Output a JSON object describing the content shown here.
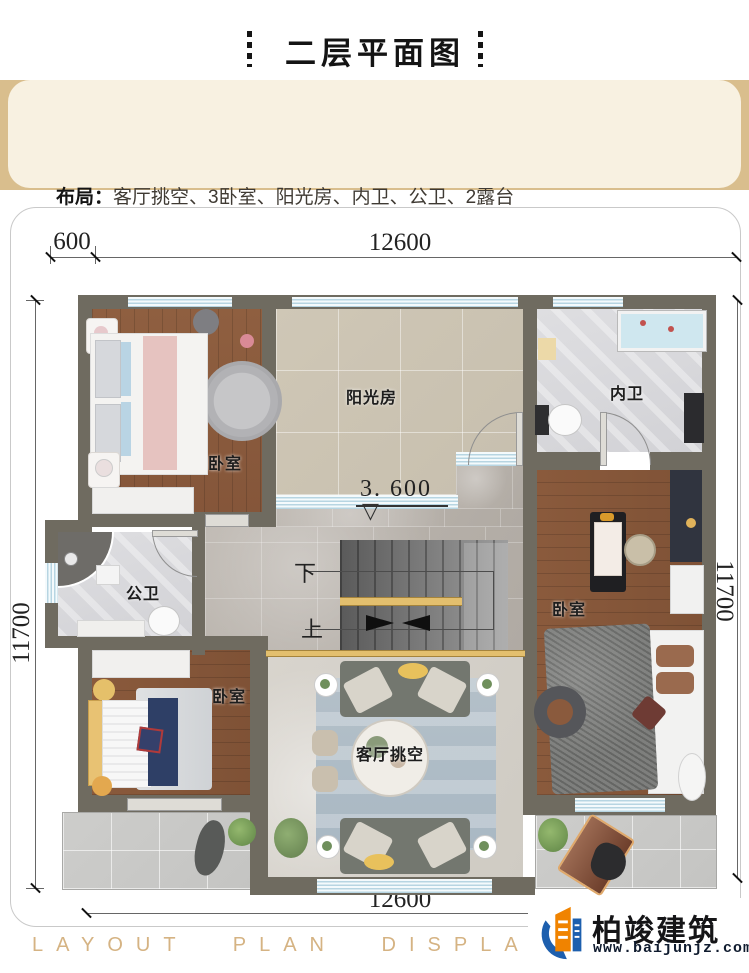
{
  "header": {
    "title": "二层平面图"
  },
  "info": {
    "layout_label": "布局：",
    "layout_value": "客厅挑空、3卧室、阳光房、内卫、公卫、2露台",
    "diamond": "◆",
    "area_label": "本层建筑面积:",
    "area_value": "125.24m",
    "area_sup": "2",
    "accent_color": "#d8991b",
    "banner_gold": "#d9be8d",
    "banner_cream": "#f8f1e1"
  },
  "plan": {
    "dims": {
      "top_left": "600",
      "top": "12600",
      "bottom": "12600",
      "left": "11700",
      "right": "11700"
    },
    "level": "3. 600",
    "level_marker": "▽",
    "rooms": {
      "sunroom": "阳光房",
      "inner_bath": "内卫",
      "bedroom_tl": "卧室",
      "public_bath": "公卫",
      "bedroom_bl": "卧室",
      "bedroom_r": "卧室",
      "living": "客厅挑空"
    },
    "stairs": {
      "down": "下",
      "up": "上"
    },
    "wall_color": "#6f6b60"
  },
  "footer": {
    "strip": "LAYOUT PLAN DISPLAY LAYOUT PLAN DISPLAY",
    "brand": "柏竣建筑",
    "url": "www.baijunjz.com",
    "brand_orange": "#f08300",
    "brand_blue": "#1d5fae"
  }
}
